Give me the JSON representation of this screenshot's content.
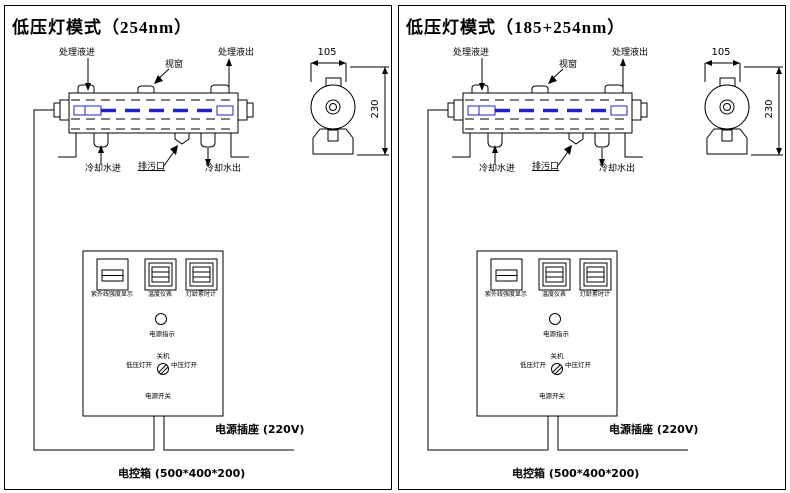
{
  "colors": {
    "line": "#000000",
    "lamp": "#2222cc",
    "background": "#ffffff"
  },
  "panels": [
    {
      "title": "低压灯模式（254nm）"
    },
    {
      "title": "低压灯模式（185+254nm）"
    }
  ],
  "diagram": {
    "inlet_label": "处理液进",
    "window_label": "视窗",
    "outlet_label": "处理液出",
    "cooling_in_label": "冷却水进",
    "drain_label": "排污口",
    "cooling_out_label": "冷却水出",
    "dim_width": "105",
    "dim_height": "230"
  },
  "control_box": {
    "instrument1_label": "紫外线强度显示",
    "instrument2_label": "温度仪表",
    "instrument3_label": "灯龄累时计",
    "power_indicator_label": "电源指示",
    "switch_off_label": "关机",
    "switch_low_label": "低压灯开",
    "switch_mid_label": "中压灯开",
    "power_switch_label": "电源开关",
    "socket_label": "电源插座 (220V)",
    "box_size_label": "电控箱 (500*400*200)"
  }
}
